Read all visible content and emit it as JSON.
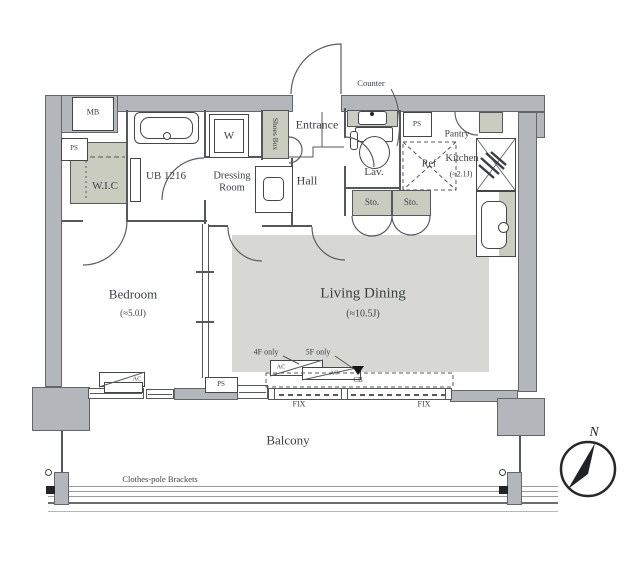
{
  "meta": {
    "type": "apartment floor plan"
  },
  "colors": {
    "wall": "#b3b6ba",
    "outline": "#54575b",
    "room_shade": "#d7d8d3",
    "closet_shade": "#c9ccbf",
    "text": "#3d4146"
  },
  "rooms": {
    "bedroom": {
      "name": "Bedroom",
      "size": "(≈5.0J)"
    },
    "living_dining": {
      "name": "Living Dining",
      "size": "(≈10.5J)"
    },
    "kitchen": {
      "name": "Kitchen",
      "size": "(≈2.1J)"
    },
    "wic": {
      "name": "W.I.C"
    },
    "unit_bath": {
      "name": "UB 1216"
    },
    "dressing_room": {
      "name": "Dressing Room"
    },
    "hall": {
      "name": "Hall"
    },
    "entrance": {
      "name": "Entrance"
    },
    "lavatory": {
      "name": "Lav."
    },
    "pantry": {
      "name": "Pantry"
    },
    "balcony": {
      "name": "Balcony"
    }
  },
  "fixtures": {
    "meter_box": "MB",
    "pipe_space_wic": "PS",
    "pipe_space_lav": "PS",
    "pipe_space_bottom": "PS",
    "washer": "W",
    "shoes_box": "Shoes Box",
    "counter": "Counter",
    "refrigerator": "Ref",
    "storage_a": "Sto.",
    "storage_b": "Sto.",
    "ac_bedroom": "AC",
    "ac_4f": "AC",
    "ac_5f": "AC",
    "note_4f": "4F only",
    "note_5f": "5F only",
    "curtain_box": "CB",
    "fix_window_left": "FIX",
    "fix_window_right": "FIX",
    "clothes_pole": "Clothes-pole Brackets"
  },
  "compass": {
    "north": "N"
  }
}
